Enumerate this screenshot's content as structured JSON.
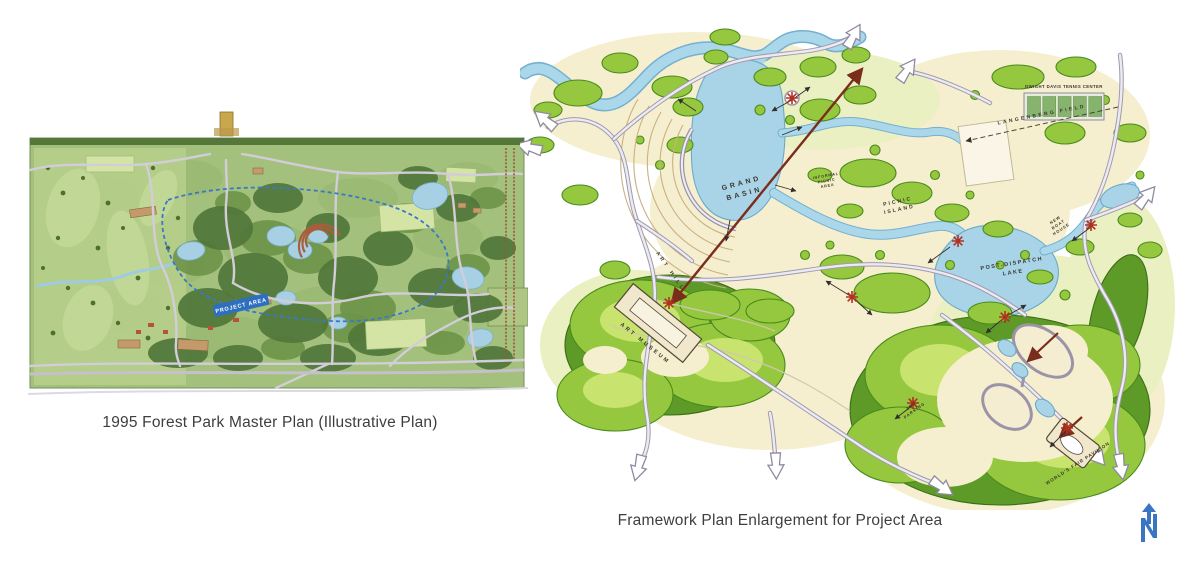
{
  "slide": {
    "background": "#ffffff"
  },
  "left_figure": {
    "caption": "1995 Forest Park Master Plan (Illustrative Plan)",
    "project_area_label": "PROJECT AREA"
  },
  "right_figure": {
    "caption": "Framework Plan Enlargement for Project Area",
    "labels": {
      "grand_basin_l1": "GRAND",
      "grand_basin_l2": "BASIN",
      "picnic_island_l1": "PICNIC",
      "picnic_island_l2": "ISLAND",
      "post_dispatch_l1": "POST-DISPATCH",
      "post_dispatch_l2": "LAKE",
      "art_hill": "ART HILL",
      "art_museum": "ART MUSEUM",
      "tennis_center": "DWIGHT DAVIS TENNIS CENTER",
      "langenberg_field": "LANGENBERG FIELD",
      "new_boat_house_l1": "NEW",
      "new_boat_house_l2": "BOAT",
      "new_boat_house_l3": "HOUSE",
      "worlds_fair_pavilion": "WORLD'S FAIR PAVILION",
      "zoo_parking_l1": "ZOO",
      "zoo_parking_l2": "PARKING",
      "informal_l1": "INFORMAL",
      "informal_l2": "PICNIC",
      "informal_l3": "AREA"
    }
  },
  "north_arrow": {
    "letter": "N",
    "color": "#3a75c4"
  },
  "colors": {
    "water": "#a9d4e8",
    "foliage": "#95c83e",
    "cream": "#f6efcf",
    "road": "#a09aad",
    "axis_red": "#7b2d1d",
    "marker_red": "#b23020",
    "project_boundary_blue": "#2e6fc0",
    "caption_text": "#3e3e3e"
  }
}
